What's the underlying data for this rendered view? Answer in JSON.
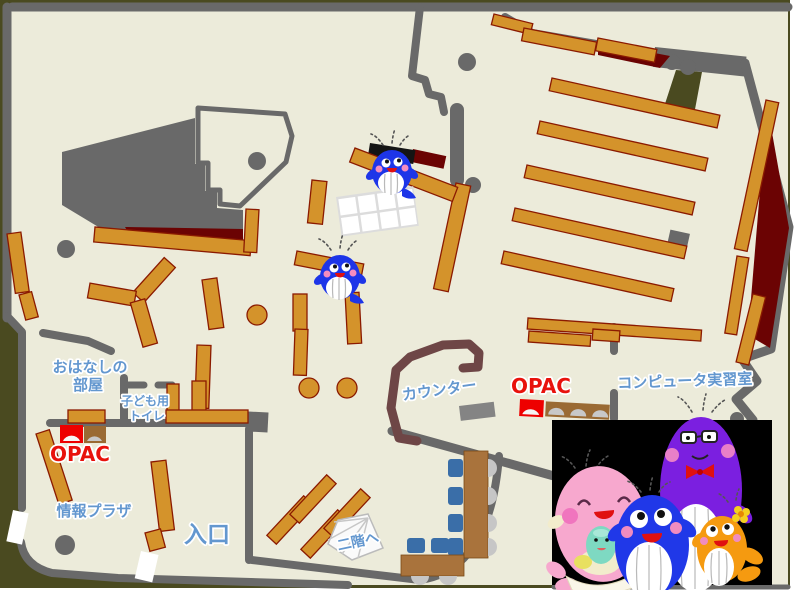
{
  "image_type": "library-first-floor-map",
  "labels": {
    "storytelling_room": {
      "line1": "おはなしの",
      "line2": "部屋"
    },
    "kids_toilet": {
      "line1": "子ども用",
      "line2": "トイレ"
    },
    "opac_left": "OPAC",
    "opac_center": "OPAC",
    "info_plaza": "情報プラザ",
    "entrance": "入口",
    "counter": "カウンター",
    "computer_room": "コンピュータ実習室",
    "to_second_floor": "二階へ"
  },
  "colors": {
    "floor": "#ECEBDA",
    "wall": "#696969",
    "background": "#4A4A20",
    "bookshelf": "#D4932B",
    "bookshelf_border": "#8B1A00",
    "dark_red_area": "#6B0303",
    "counter_desk": "#6E4646",
    "computer_desk": "#A9733C",
    "chair": "#3A6EA8",
    "opac_terminal": "#EE0000",
    "label_blue": "#6397CF",
    "label_red": "#E8120C",
    "photo_background": "#000000",
    "mascot_blue": "#1D35E8",
    "mascot_pink": "#F7A8CE",
    "mascot_purple": "#7B1FE0",
    "mascot_orange": "#F59A10",
    "mascot_mint": "#7ED9C2"
  },
  "mascots": {
    "on_map": [
      "blue-whale",
      "blue-whale"
    ],
    "photo": [
      "pink-whale-with-baby",
      "blue-whale",
      "purple-whale-with-glasses",
      "orange-whale"
    ]
  }
}
